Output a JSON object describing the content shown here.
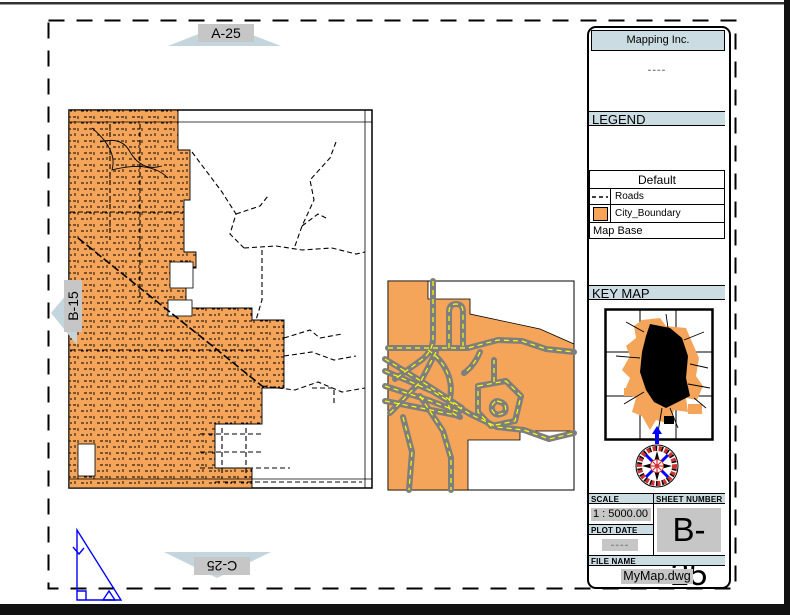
{
  "nav": {
    "top_sheet": "A-25",
    "left_sheet": "B-15",
    "bottom_sheet": "C-25"
  },
  "title_block": {
    "company": "Mapping Inc.",
    "note_placeholder": "----",
    "legend_header": "LEGEND",
    "legend_group": "Default",
    "legend_items": [
      {
        "symbol": "dashed-line",
        "label": "Roads"
      },
      {
        "symbol": "orange-swatch",
        "label": "City_Boundary"
      }
    ],
    "legend_base": "Map Base",
    "keymap_header": "KEY MAP",
    "scale_header": "SCALE",
    "scale_value": "1 : 5000.00",
    "sheet_number_header": "SHEET NUMBER",
    "sheet_number_value": "B-25",
    "plot_date_header": "PLOT DATE",
    "plot_date_value": "----",
    "file_name_header": "FILE NAME",
    "file_name_value": "MyMap.dwg"
  },
  "colors": {
    "city_boundary_orange": "#F4A55A",
    "header_blue": "#CBDCE3",
    "arrow_blue": "#C4D5DD",
    "label_gray_bg": "#C6C6C6",
    "road_gray": "#7E7E7E",
    "road_dash_yellow": "#FFFF00",
    "triangle_blue": "#0000FF",
    "compass_red": "#D03030"
  }
}
